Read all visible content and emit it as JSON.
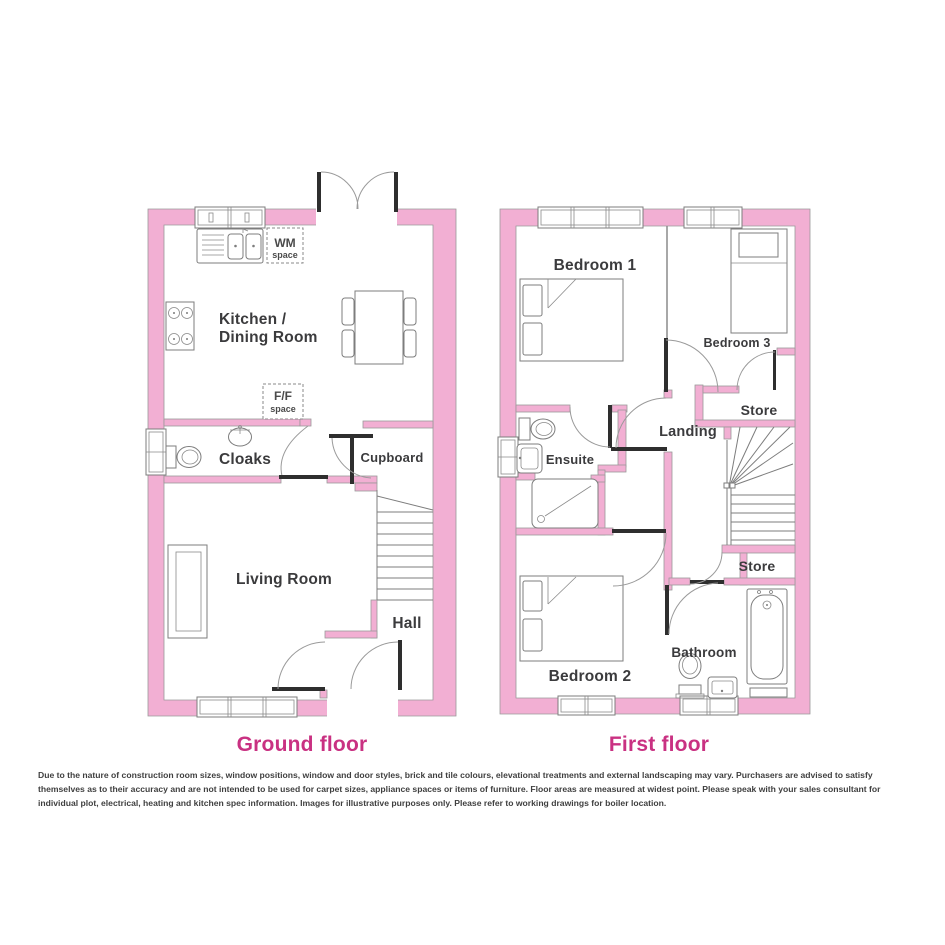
{
  "ground_floor": {
    "title": "Ground floor",
    "rooms": {
      "kitchen_line1": "Kitchen /",
      "kitchen_line2": "Dining Room",
      "cloaks": "Cloaks",
      "cupboard": "Cupboard",
      "living_room": "Living Room",
      "hall": "Hall"
    },
    "appliances": {
      "wm_line1": "WM",
      "wm_line2": "space",
      "ff_line1": "F/F",
      "ff_line2": "space"
    }
  },
  "first_floor": {
    "title": "First floor",
    "rooms": {
      "bedroom1": "Bedroom 1",
      "bedroom3": "Bedroom 3",
      "landing": "Landing",
      "store_upper": "Store",
      "ensuite": "Ensuite",
      "store_lower": "Store",
      "bedroom2": "Bedroom 2",
      "bathroom": "Bathroom"
    }
  },
  "disclaimer": "Due to the nature of construction room sizes, window positions, window and door styles, brick and tile colours, elevational treatments and external landscaping may vary. Purchasers are advised to satisfy themselves as to their accuracy and are not intended to be used for carpet sizes, appliance spaces or items of furniture. Floor areas are measured at widest point. Please speak with your sales consultant for individual plot, electrical, heating and kitchen spec information. Images for illustrative purposes only. Please refer to working drawings for boiler location.",
  "colors": {
    "wall_pink": "#F2AFD3",
    "wall_outline": "#9a9a9a",
    "drawing_line": "#7d7d7d",
    "door_leaf": "#2e2e2e",
    "room_label": "#3b3b3d",
    "floor_title": "#c93182"
  }
}
